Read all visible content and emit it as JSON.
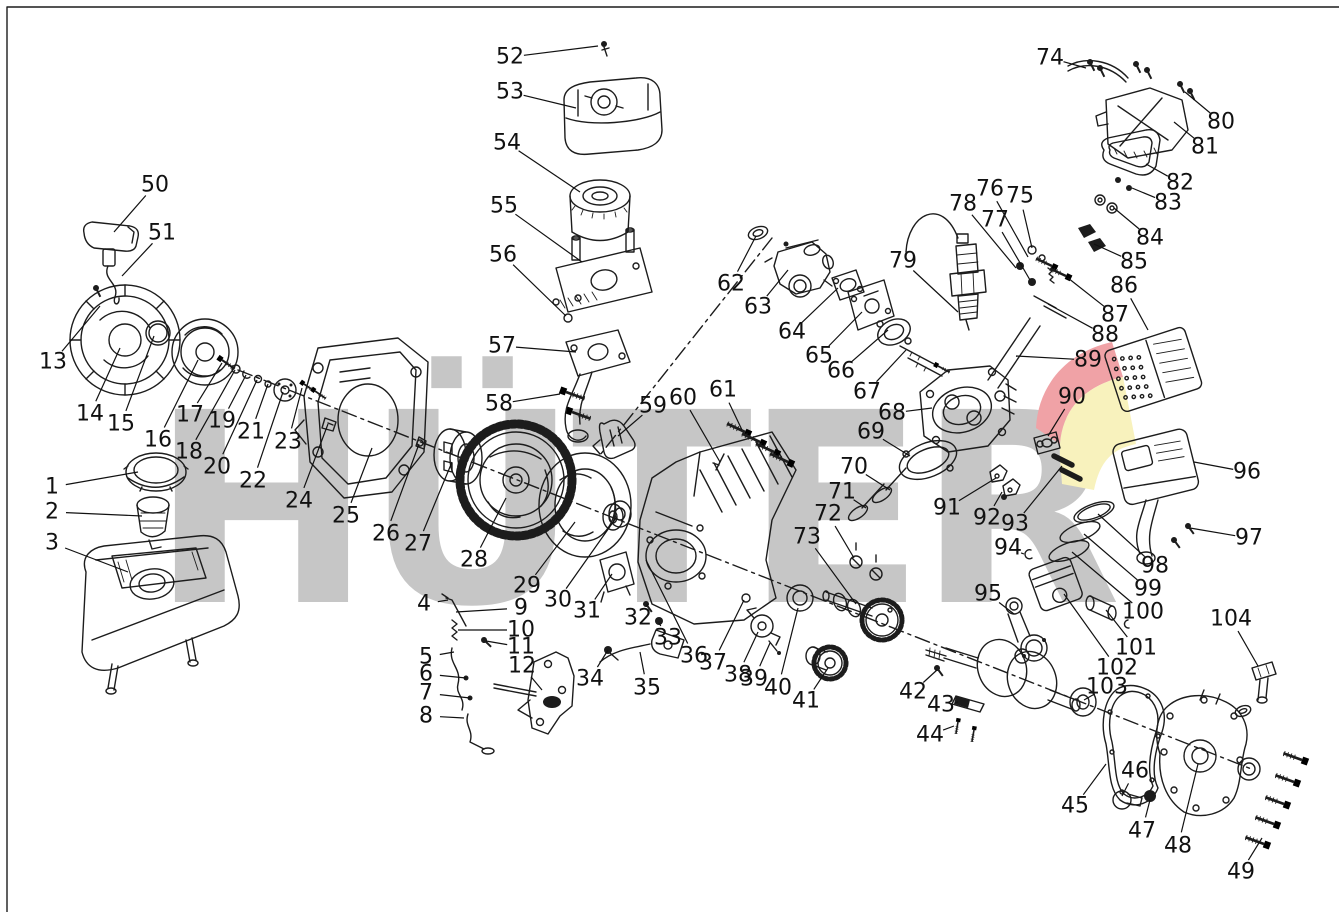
{
  "watermark": {
    "text": "HÜTER",
    "gray": "#c6c6c6",
    "red": "#f0a2a6",
    "yellow": "#f8f2bd"
  },
  "diagram": {
    "type": "exploded-parts-diagram",
    "subject": "gasoline-engine",
    "labels": [
      {
        "n": "1",
        "x": 52,
        "y": 487,
        "tx": 138,
        "ty": 472
      },
      {
        "n": "2",
        "x": 52,
        "y": 512,
        "tx": 142,
        "ty": 516
      },
      {
        "n": "3",
        "x": 52,
        "y": 543,
        "tx": 128,
        "ty": 572
      },
      {
        "n": "4",
        "x": 424,
        "y": 604,
        "tx": 448,
        "ty": 600
      },
      {
        "n": "5",
        "x": 426,
        "y": 657,
        "tx": 454,
        "ty": 652
      },
      {
        "n": "6",
        "x": 426,
        "y": 674,
        "tx": 466,
        "ty": 678
      },
      {
        "n": "7",
        "x": 426,
        "y": 693,
        "tx": 470,
        "ty": 698
      },
      {
        "n": "8",
        "x": 426,
        "y": 716,
        "tx": 464,
        "ty": 718
      },
      {
        "n": "9",
        "x": 521,
        "y": 608,
        "tx": 456,
        "ty": 612
      },
      {
        "n": "10",
        "x": 521,
        "y": 630,
        "tx": 458,
        "ty": 630
      },
      {
        "n": "11",
        "x": 521,
        "y": 647,
        "tx": 486,
        "ty": 641
      },
      {
        "n": "12",
        "x": 522,
        "y": 666,
        "tx": 542,
        "ty": 690
      },
      {
        "n": "13",
        "x": 53,
        "y": 362,
        "tx": 100,
        "ty": 306
      },
      {
        "n": "14",
        "x": 90,
        "y": 414,
        "tx": 120,
        "ty": 348
      },
      {
        "n": "15",
        "x": 121,
        "y": 424,
        "tx": 154,
        "ty": 336
      },
      {
        "n": "16",
        "x": 158,
        "y": 440,
        "tx": 198,
        "ty": 360
      },
      {
        "n": "17",
        "x": 190,
        "y": 415,
        "tx": 222,
        "ty": 363
      },
      {
        "n": "18",
        "x": 189,
        "y": 452,
        "tx": 235,
        "ty": 370
      },
      {
        "n": "19",
        "x": 222,
        "y": 421,
        "tx": 246,
        "ty": 375
      },
      {
        "n": "20",
        "x": 217,
        "y": 467,
        "tx": 257,
        "ty": 380
      },
      {
        "n": "21",
        "x": 251,
        "y": 432,
        "tx": 268,
        "ty": 384
      },
      {
        "n": "22",
        "x": 253,
        "y": 481,
        "tx": 283,
        "ty": 392
      },
      {
        "n": "23",
        "x": 288,
        "y": 442,
        "tx": 302,
        "ty": 388
      },
      {
        "n": "24",
        "x": 299,
        "y": 501,
        "tx": 328,
        "ty": 424
      },
      {
        "n": "25",
        "x": 346,
        "y": 516,
        "tx": 372,
        "ty": 448
      },
      {
        "n": "26",
        "x": 386,
        "y": 534,
        "tx": 419,
        "ty": 444
      },
      {
        "n": "27",
        "x": 418,
        "y": 544,
        "tx": 452,
        "ty": 462
      },
      {
        "n": "28",
        "x": 474,
        "y": 560,
        "tx": 506,
        "ty": 498
      },
      {
        "n": "29",
        "x": 527,
        "y": 586,
        "tx": 575,
        "ty": 522
      },
      {
        "n": "30",
        "x": 558,
        "y": 600,
        "tx": 616,
        "ty": 518
      },
      {
        "n": "31",
        "x": 587,
        "y": 611,
        "tx": 612,
        "ty": 574
      },
      {
        "n": "32",
        "x": 638,
        "y": 618,
        "tx": 648,
        "ty": 604
      },
      {
        "n": "33",
        "x": 668,
        "y": 638,
        "tx": 659,
        "ty": 623
      },
      {
        "n": "34",
        "x": 590,
        "y": 679,
        "tx": 608,
        "ty": 650
      },
      {
        "n": "35",
        "x": 647,
        "y": 688,
        "tx": 640,
        "ty": 652
      },
      {
        "n": "36",
        "x": 694,
        "y": 656,
        "tx": 646,
        "ty": 560
      },
      {
        "n": "37",
        "x": 713,
        "y": 663,
        "tx": 744,
        "ty": 600
      },
      {
        "n": "38",
        "x": 738,
        "y": 675,
        "tx": 758,
        "ty": 632
      },
      {
        "n": "39",
        "x": 754,
        "y": 679,
        "tx": 770,
        "ty": 643
      },
      {
        "n": "40",
        "x": 778,
        "y": 688,
        "tx": 798,
        "ty": 608
      },
      {
        "n": "41",
        "x": 806,
        "y": 701,
        "tx": 828,
        "ty": 668
      },
      {
        "n": "42",
        "x": 913,
        "y": 692,
        "tx": 937,
        "ty": 670
      },
      {
        "n": "43",
        "x": 941,
        "y": 705,
        "tx": 958,
        "ty": 702
      },
      {
        "n": "44",
        "x": 930,
        "y": 735,
        "tx": 954,
        "ty": 726
      },
      {
        "n": "45",
        "x": 1075,
        "y": 806,
        "tx": 1106,
        "ty": 764
      },
      {
        "n": "46",
        "x": 1135,
        "y": 771,
        "tx": 1122,
        "ty": 796
      },
      {
        "n": "47",
        "x": 1142,
        "y": 831,
        "tx": 1150,
        "ty": 800
      },
      {
        "n": "48",
        "x": 1178,
        "y": 846,
        "tx": 1198,
        "ty": 764
      },
      {
        "n": "49",
        "x": 1241,
        "y": 872,
        "tx": 1262,
        "ty": 838
      },
      {
        "n": "50",
        "x": 155,
        "y": 185,
        "tx": 114,
        "ty": 232
      },
      {
        "n": "51",
        "x": 162,
        "y": 233,
        "tx": 122,
        "ty": 276
      },
      {
        "n": "52",
        "x": 510,
        "y": 57,
        "tx": 598,
        "ty": 46
      },
      {
        "n": "53",
        "x": 510,
        "y": 92,
        "tx": 576,
        "ty": 108
      },
      {
        "n": "54",
        "x": 507,
        "y": 143,
        "tx": 580,
        "ty": 192
      },
      {
        "n": "55",
        "x": 504,
        "y": 206,
        "tx": 582,
        "ty": 262
      },
      {
        "n": "56",
        "x": 503,
        "y": 255,
        "tx": 566,
        "ty": 316
      },
      {
        "n": "57",
        "x": 502,
        "y": 346,
        "tx": 576,
        "ty": 352
      },
      {
        "n": "58",
        "x": 499,
        "y": 404,
        "tx": 560,
        "ty": 394
      },
      {
        "n": "59",
        "x": 653,
        "y": 406,
        "tx": 618,
        "ty": 436
      },
      {
        "n": "60",
        "x": 683,
        "y": 398,
        "tx": 720,
        "ty": 462
      },
      {
        "n": "61",
        "x": 723,
        "y": 390,
        "tx": 742,
        "ty": 430
      },
      {
        "n": "62",
        "x": 731,
        "y": 284,
        "tx": 756,
        "ty": 236
      },
      {
        "n": "63",
        "x": 758,
        "y": 307,
        "tx": 788,
        "ty": 270
      },
      {
        "n": "64",
        "x": 792,
        "y": 332,
        "tx": 838,
        "ty": 288
      },
      {
        "n": "65",
        "x": 819,
        "y": 356,
        "tx": 862,
        "ty": 312
      },
      {
        "n": "66",
        "x": 841,
        "y": 371,
        "tx": 888,
        "ty": 330
      },
      {
        "n": "67",
        "x": 867,
        "y": 392,
        "tx": 906,
        "ty": 350
      },
      {
        "n": "68",
        "x": 892,
        "y": 413,
        "tx": 932,
        "ty": 408
      },
      {
        "n": "69",
        "x": 871,
        "y": 432,
        "tx": 910,
        "ty": 456
      },
      {
        "n": "70",
        "x": 854,
        "y": 467,
        "tx": 890,
        "ty": 490
      },
      {
        "n": "71",
        "x": 842,
        "y": 492,
        "tx": 866,
        "ty": 508
      },
      {
        "n": "72",
        "x": 828,
        "y": 514,
        "tx": 854,
        "ty": 558
      },
      {
        "n": "73",
        "x": 807,
        "y": 537,
        "tx": 856,
        "ty": 604
      },
      {
        "n": "74",
        "x": 1050,
        "y": 58,
        "tx": 1086,
        "ty": 68
      },
      {
        "n": "75",
        "x": 1020,
        "y": 196,
        "tx": 1032,
        "ty": 248
      },
      {
        "n": "76",
        "x": 990,
        "y": 189,
        "tx": 1028,
        "ty": 257
      },
      {
        "n": "77",
        "x": 995,
        "y": 220,
        "tx": 1030,
        "ty": 280
      },
      {
        "n": "78",
        "x": 963,
        "y": 204,
        "tx": 1016,
        "ty": 268
      },
      {
        "n": "79",
        "x": 903,
        "y": 261,
        "tx": 958,
        "ty": 312
      },
      {
        "n": "80",
        "x": 1221,
        "y": 122,
        "tx": 1185,
        "ty": 92
      },
      {
        "n": "81",
        "x": 1205,
        "y": 147,
        "tx": 1174,
        "ty": 122
      },
      {
        "n": "82",
        "x": 1180,
        "y": 183,
        "tx": 1146,
        "ty": 164
      },
      {
        "n": "83",
        "x": 1168,
        "y": 203,
        "tx": 1132,
        "ty": 188
      },
      {
        "n": "84",
        "x": 1150,
        "y": 238,
        "tx": 1114,
        "ty": 208
      },
      {
        "n": "85",
        "x": 1134,
        "y": 262,
        "tx": 1094,
        "ty": 244
      },
      {
        "n": "86",
        "x": 1124,
        "y": 286,
        "tx": 1148,
        "ty": 330
      },
      {
        "n": "87",
        "x": 1115,
        "y": 315,
        "tx": 1068,
        "ty": 278
      },
      {
        "n": "88",
        "x": 1105,
        "y": 335,
        "tx": 1048,
        "ty": 304
      },
      {
        "n": "89",
        "x": 1088,
        "y": 360,
        "tx": 1016,
        "ty": 356
      },
      {
        "n": "90",
        "x": 1072,
        "y": 397,
        "tx": 1048,
        "ty": 436
      },
      {
        "n": "91",
        "x": 947,
        "y": 508,
        "tx": 996,
        "ty": 478
      },
      {
        "n": "92",
        "x": 987,
        "y": 518,
        "tx": 1002,
        "ty": 492
      },
      {
        "n": "93",
        "x": 1015,
        "y": 524,
        "tx": 1062,
        "ty": 466
      },
      {
        "n": "94",
        "x": 1008,
        "y": 548,
        "tx": 1024,
        "ty": 554
      },
      {
        "n": "95",
        "x": 988,
        "y": 594,
        "tx": 1014,
        "ty": 614
      },
      {
        "n": "96",
        "x": 1247,
        "y": 472,
        "tx": 1194,
        "ty": 462
      },
      {
        "n": "97",
        "x": 1249,
        "y": 538,
        "tx": 1190,
        "ty": 528
      },
      {
        "n": "98",
        "x": 1155,
        "y": 566,
        "tx": 1098,
        "ty": 514
      },
      {
        "n": "99",
        "x": 1148,
        "y": 589,
        "tx": 1084,
        "ty": 534
      },
      {
        "n": "100",
        "x": 1143,
        "y": 612,
        "tx": 1072,
        "ty": 552
      },
      {
        "n": "101",
        "x": 1136,
        "y": 648,
        "tx": 1106,
        "ty": 610
      },
      {
        "n": "102",
        "x": 1117,
        "y": 668,
        "tx": 1064,
        "ty": 594
      },
      {
        "n": "103",
        "x": 1107,
        "y": 687,
        "tx": 1084,
        "ty": 700
      },
      {
        "n": "104",
        "x": 1231,
        "y": 619,
        "tx": 1258,
        "ty": 666
      }
    ]
  }
}
